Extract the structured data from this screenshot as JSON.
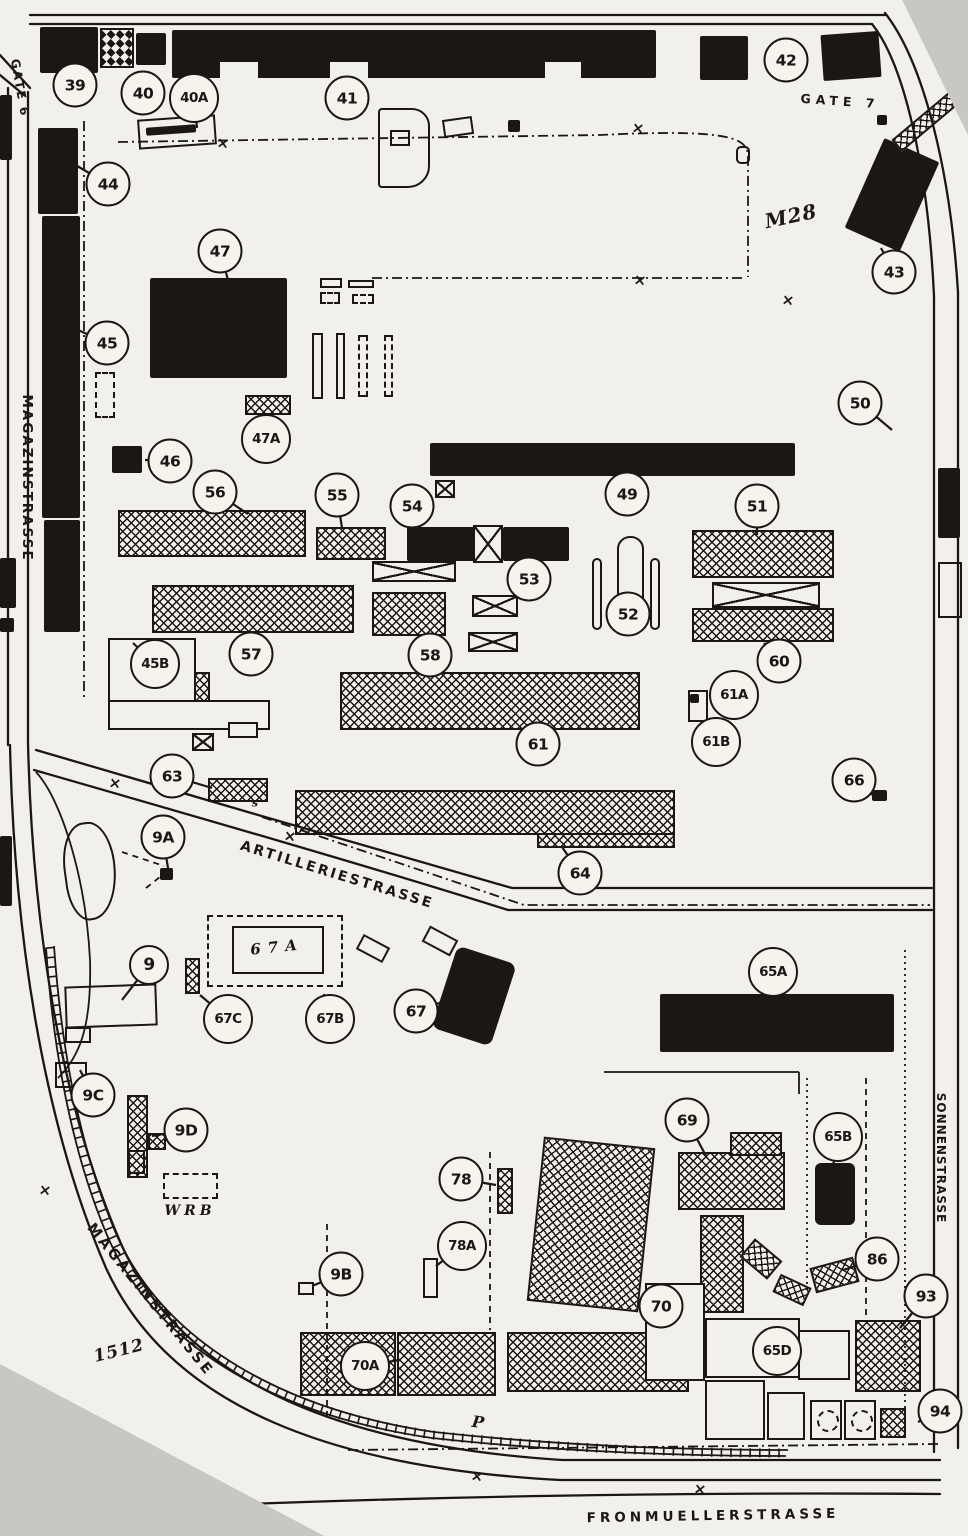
{
  "colors": {
    "paper": "#f2f0ea",
    "ink": "#1a1715",
    "backing": "#c8c7c3"
  },
  "map": {
    "markers": [
      {
        "label": "39",
        "x": 75,
        "y": 85
      },
      {
        "label": "40",
        "x": 143,
        "y": 93
      },
      {
        "label": "40A",
        "x": 194,
        "y": 98,
        "lx": 197,
        "ly": 128
      },
      {
        "label": "41",
        "x": 347,
        "y": 98
      },
      {
        "label": "42",
        "x": 786,
        "y": 60
      },
      {
        "label": "43",
        "x": 894,
        "y": 272,
        "lx": 881,
        "ly": 248
      },
      {
        "label": "44",
        "x": 108,
        "y": 184,
        "lx": 72,
        "ly": 163
      },
      {
        "label": "45",
        "x": 107,
        "y": 343,
        "lx": 78,
        "ly": 330
      },
      {
        "label": "45B",
        "x": 155,
        "y": 664,
        "lx": 133,
        "ly": 643
      },
      {
        "label": "46",
        "x": 170,
        "y": 461,
        "lx": 145,
        "ly": 460
      },
      {
        "label": "47",
        "x": 220,
        "y": 251,
        "lx": 228,
        "ly": 280
      },
      {
        "label": "47A",
        "x": 266,
        "y": 439,
        "lx": 266,
        "ly": 416
      },
      {
        "label": "49",
        "x": 627,
        "y": 494,
        "lx": 620,
        "ly": 477
      },
      {
        "label": "50",
        "x": 860,
        "y": 403,
        "lx": 892,
        "ly": 430
      },
      {
        "label": "51",
        "x": 757,
        "y": 506,
        "lx": 757,
        "ly": 535
      },
      {
        "label": "52",
        "x": 628,
        "y": 614,
        "lx": 628,
        "ly": 598
      },
      {
        "label": "53",
        "x": 529,
        "y": 579
      },
      {
        "label": "54",
        "x": 412,
        "y": 506,
        "lx": 420,
        "ly": 528
      },
      {
        "label": "55",
        "x": 337,
        "y": 495,
        "lx": 342,
        "ly": 528
      },
      {
        "label": "56",
        "x": 215,
        "y": 492,
        "lx": 248,
        "ly": 514
      },
      {
        "label": "57",
        "x": 251,
        "y": 654,
        "lx": 251,
        "ly": 634
      },
      {
        "label": "58",
        "x": 430,
        "y": 655,
        "lx": 420,
        "ly": 637
      },
      {
        "label": "60",
        "x": 779,
        "y": 661,
        "lx": 764,
        "ly": 643
      },
      {
        "label": "61",
        "x": 538,
        "y": 744,
        "lx": 550,
        "ly": 731
      },
      {
        "label": "61A",
        "x": 734,
        "y": 695,
        "lx": 710,
        "ly": 700
      },
      {
        "label": "61B",
        "x": 716,
        "y": 742,
        "lx": 700,
        "ly": 724
      },
      {
        "label": "63",
        "x": 172,
        "y": 776,
        "lx": 212,
        "ly": 788
      },
      {
        "label": "64",
        "x": 580,
        "y": 873,
        "lx": 562,
        "ly": 847
      },
      {
        "label": "65A",
        "x": 773,
        "y": 972,
        "lx": 775,
        "ly": 995
      },
      {
        "label": "65B",
        "x": 838,
        "y": 1137,
        "lx": 833,
        "ly": 1166
      },
      {
        "label": "65D",
        "x": 777,
        "y": 1351,
        "lx": 800,
        "ly": 1354
      },
      {
        "label": "66",
        "x": 854,
        "y": 780,
        "lx": 874,
        "ly": 796
      },
      {
        "label": "67",
        "x": 416,
        "y": 1011,
        "lx": 448,
        "ly": 1000
      },
      {
        "label": "67B",
        "x": 330,
        "y": 1019,
        "lx": 324,
        "ly": 994
      },
      {
        "label": "67C",
        "x": 228,
        "y": 1019,
        "lx": 200,
        "ly": 995
      },
      {
        "label": "69",
        "x": 687,
        "y": 1120,
        "lx": 706,
        "ly": 1156
      },
      {
        "label": "70",
        "x": 661,
        "y": 1306,
        "lx": 645,
        "ly": 1295
      },
      {
        "label": "70A",
        "x": 365,
        "y": 1366,
        "lx": 399,
        "ly": 1360
      },
      {
        "label": "78",
        "x": 461,
        "y": 1179,
        "lx": 496,
        "ly": 1185
      },
      {
        "label": "78A",
        "x": 462,
        "y": 1246,
        "lx": 436,
        "ly": 1266
      },
      {
        "label": "86",
        "x": 877,
        "y": 1259,
        "lx": 843,
        "ly": 1270
      },
      {
        "label": "93",
        "x": 926,
        "y": 1296,
        "lx": 900,
        "ly": 1328
      },
      {
        "label": "94",
        "x": 940,
        "y": 1411,
        "lx": 918,
        "ly": 1422
      },
      {
        "label": "9",
        "x": 149,
        "y": 965,
        "lx": 122,
        "ly": 1000
      },
      {
        "label": "9A",
        "x": 163,
        "y": 837,
        "lx": 168,
        "ly": 868
      },
      {
        "label": "9B",
        "x": 341,
        "y": 1274,
        "lx": 312,
        "ly": 1286
      },
      {
        "label": "9C",
        "x": 93,
        "y": 1095,
        "lx": 80,
        "ly": 1070
      },
      {
        "label": "9D",
        "x": 186,
        "y": 1130,
        "lx": 152,
        "ly": 1136
      }
    ],
    "streets": [
      {
        "text": "MAGAZINSTRASSE",
        "x": 27,
        "y": 478,
        "rot": 90,
        "ls": 2,
        "fs": 13.5
      },
      {
        "text": "MAGAZINSTRASSE",
        "x": 150,
        "y": 1300,
        "rot": 51,
        "ls": 3,
        "fs": 14.5
      },
      {
        "text": "ARTILLERIESTRASSE",
        "x": 337,
        "y": 875,
        "rot": 17,
        "ls": 2.5,
        "fs": 14
      },
      {
        "text": "FRONMUELLERSTRASSE",
        "x": 713,
        "y": 1516,
        "rot": -1,
        "ls": 4,
        "fs": 13.5
      },
      {
        "text": "SONNENSTRASSE",
        "x": 941,
        "y": 1158,
        "rot": 90,
        "ls": 1,
        "fs": 12
      },
      {
        "text": "GATE 6",
        "x": 20,
        "y": 88,
        "rot": 80,
        "ls": 2,
        "fs": 12
      },
      {
        "text": "GATE 7",
        "x": 840,
        "y": 101,
        "rot": 4,
        "ls": 5,
        "fs": 12.5
      }
    ],
    "annotations": [
      {
        "text": "M28",
        "x": 791,
        "y": 216,
        "rot": -12,
        "fs": 20,
        "ls": 1
      },
      {
        "text": "1512",
        "x": 119,
        "y": 1351,
        "rot": -14,
        "fs": 17,
        "ls": 1
      },
      {
        "text": "WRB",
        "x": 190,
        "y": 1211,
        "rot": 0,
        "fs": 14,
        "ls": 4
      },
      {
        "text": "P",
        "x": 478,
        "y": 1422,
        "rot": 8,
        "fs": 16,
        "ls": 0
      },
      {
        "text": "67A",
        "x": 277,
        "y": 947,
        "rot": -6,
        "fs": 15,
        "ls": 7
      },
      {
        "text": "s",
        "x": 255,
        "y": 803,
        "rot": 0,
        "fs": 11,
        "ls": 0
      }
    ],
    "xmarks": [
      [
        223,
        143
      ],
      [
        638,
        128
      ],
      [
        640,
        280
      ],
      [
        788,
        300
      ],
      [
        115,
        783
      ],
      [
        290,
        836
      ],
      [
        45,
        1190
      ],
      [
        477,
        1476
      ],
      [
        700,
        1489
      ]
    ]
  }
}
